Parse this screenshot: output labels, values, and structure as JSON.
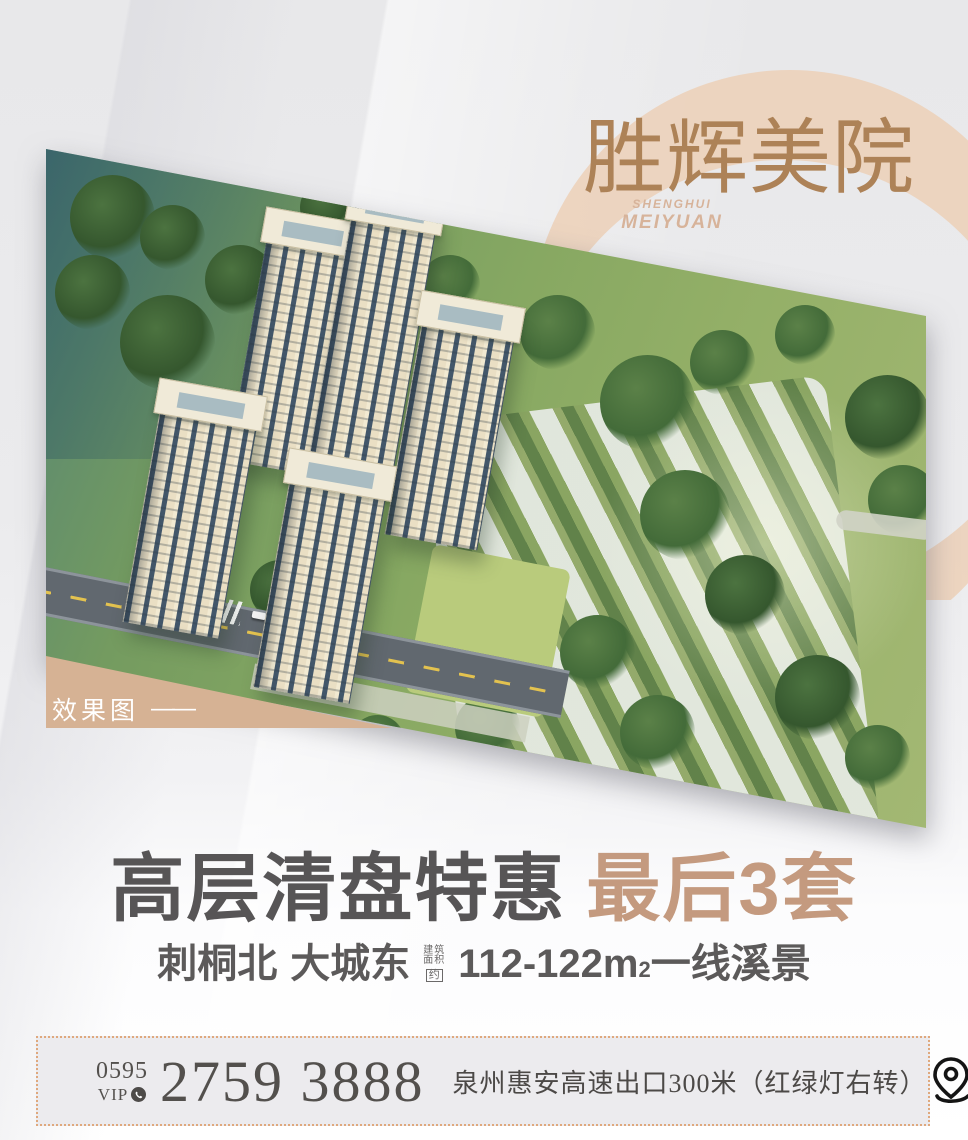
{
  "colors": {
    "logo_brown": "#ad8257",
    "logo_en_tan": "#d7b39a",
    "crescent": "#ecd2ba",
    "render_tag_bg": "#d6b294",
    "headline_gray": "#575556",
    "headline_tan": "#c49a7f",
    "subheadline_gray": "#5c5a5a",
    "contact_text": "#53504d",
    "dotted_border": "#dfa87d"
  },
  "logo": {
    "cn": "胜辉美院",
    "en_line1": "SHENGHUI",
    "en_line2": "MEIYUAN"
  },
  "photo": {
    "label": "效果图",
    "label_dash": "——"
  },
  "headline": {
    "main": "高层清盘特惠",
    "highlight": "最后3套"
  },
  "subheadline": {
    "location1": "刺桐北",
    "location2": "大城东",
    "area_prefix_line1": "建筑",
    "area_prefix_line2": "面积",
    "area_prefix_box": "约",
    "area_value": "112-122m",
    "area_sup": "2",
    "suffix": "一线溪景"
  },
  "contact": {
    "area_code": "0595",
    "vip_label": "VIP",
    "phone_number": "2759 3888",
    "address": "泉州惠安高速出口300米（红绿灯右转）"
  },
  "icons": {
    "phone": "phone-icon",
    "location_pin": "location-pin-icon"
  }
}
